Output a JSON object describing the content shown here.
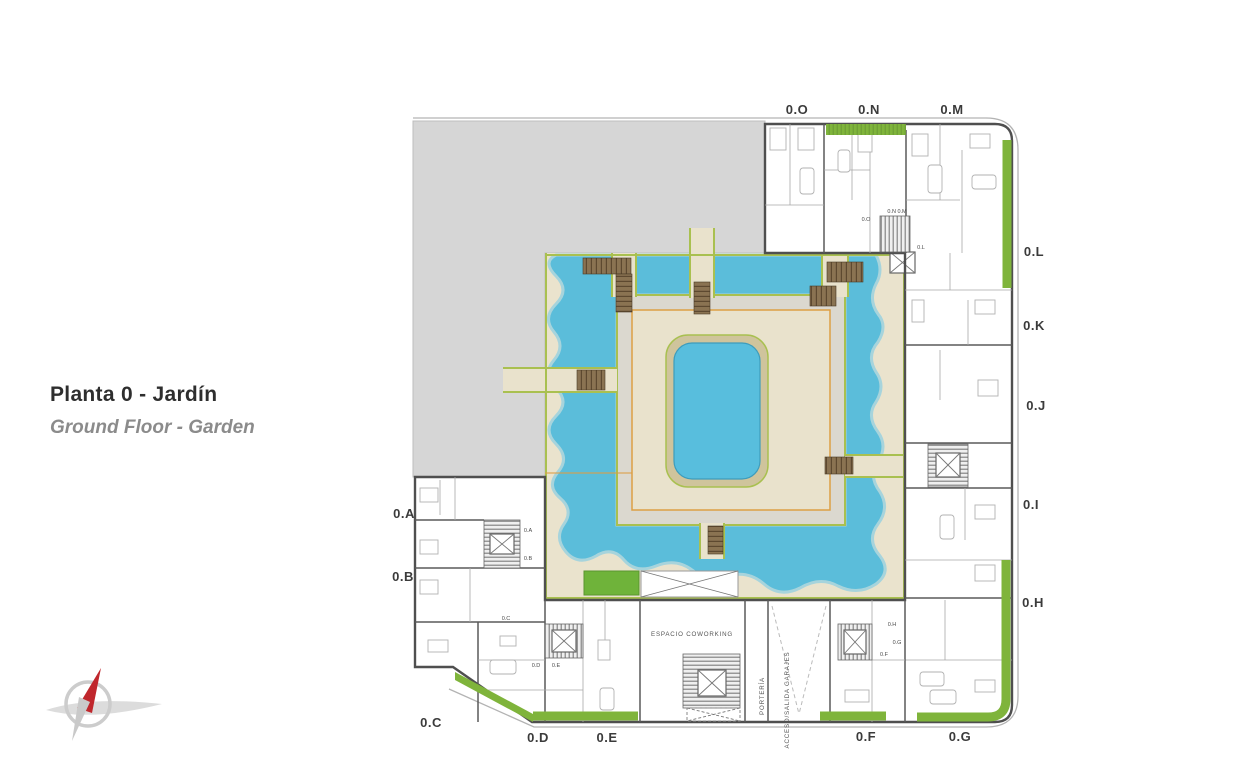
{
  "title": {
    "main": "Planta 0 - Jardín",
    "sub": "Ground Floor - Garden"
  },
  "plan": {
    "unit_labels": [
      "0.O",
      "0.N",
      "0.M",
      "0.L",
      "0.K",
      "0.J",
      "0.I",
      "0.H",
      "0.A",
      "0.B",
      "0.C",
      "0.D",
      "0.E",
      "0.F",
      "0.G"
    ],
    "door_labels": [
      "0.O",
      "0.N 0.M",
      "0.L",
      "0.A",
      "0.B",
      "0.C",
      "0.D",
      "0.E",
      "0.H",
      "0.G",
      "0.F"
    ],
    "areas": {
      "coworking": "ESPACIO COWORKING",
      "porteria": "PORTERÍA",
      "garage": "ACCESO/SALIDA GARAJES"
    },
    "colors": {
      "water": "#5bbdda",
      "terrace_sand": "#e9e2cc",
      "terrace_gray": "#dbd8cf",
      "grass": "#6fb33a",
      "edge_green": "#a9c050",
      "wood_deck": "#8a7352",
      "accent_orange": "#dd9f45",
      "neighbor_gray": "#d6d6d6",
      "compass_needle": "#c0272d"
    }
  }
}
